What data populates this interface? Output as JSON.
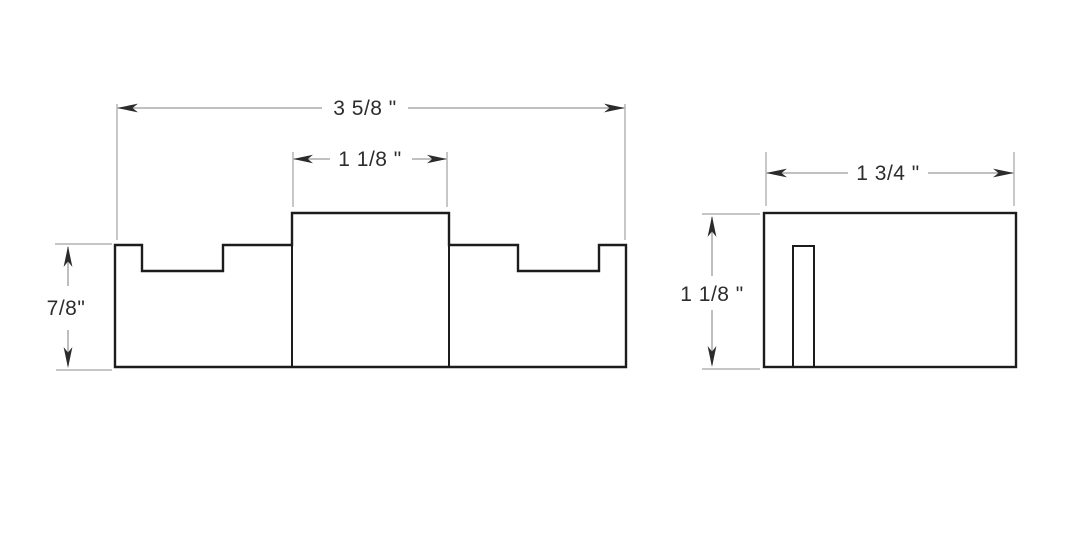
{
  "drawing": {
    "kind": "orthographic-technical-drawing",
    "background_color": "#ffffff",
    "front_view": {
      "overall_width": "3 5/8 \"",
      "center_block_width": "1 1/8 \"",
      "body_height": "7/8\""
    },
    "side_view": {
      "overall_width": "1 3/4 \"",
      "overall_height": "1 1/8 \""
    },
    "colors": {
      "outline": "#1c1c1c",
      "dimension_lines": "#9a9a9a",
      "dimension_text": "#2d2d2d",
      "arrowheads": "#2b2b2b"
    }
  }
}
